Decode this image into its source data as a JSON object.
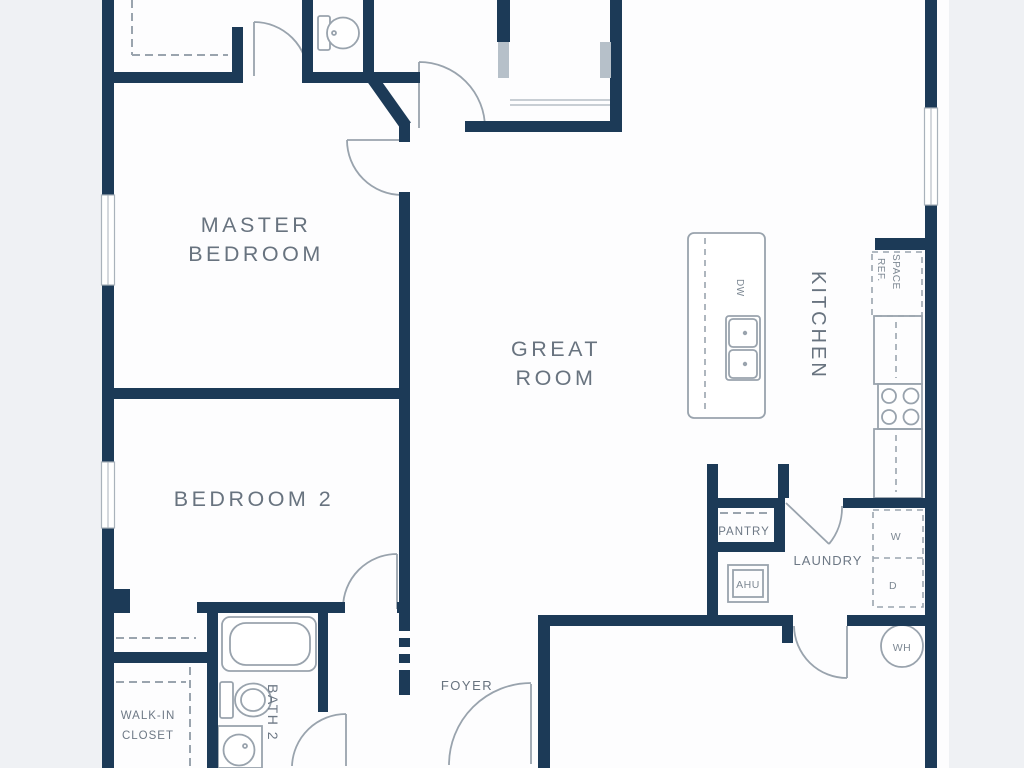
{
  "plan": {
    "rooms": {
      "master_bedroom": {
        "line1": "MASTER",
        "line2": "BEDROOM"
      },
      "bedroom_2": {
        "label": "BEDROOM 2"
      },
      "great_room": {
        "line1": "GREAT",
        "line2": "ROOM"
      },
      "kitchen": {
        "label": "KITCHEN"
      },
      "pantry": {
        "label": "PANTRY"
      },
      "laundry": {
        "label": "LAUNDRY"
      },
      "foyer": {
        "label": "FOYER"
      },
      "walk_in_closet": {
        "line1": "WALK-IN",
        "line2": "CLOSET"
      },
      "bath_2": {
        "label": "BATH 2"
      }
    },
    "fixtures": {
      "dishwasher": "DW",
      "ref_space_line1": "REF.",
      "ref_space_line2": "SPACE",
      "air_handler": "AHU",
      "washer": "W",
      "dryer": "D",
      "water_heater": "WH"
    },
    "colors": {
      "wall": "#1c3a57",
      "fixture_line": "#99a3ad",
      "label_text": "#68737f",
      "page_background": "#eff1f4",
      "floor": "#fdfdfe"
    }
  }
}
